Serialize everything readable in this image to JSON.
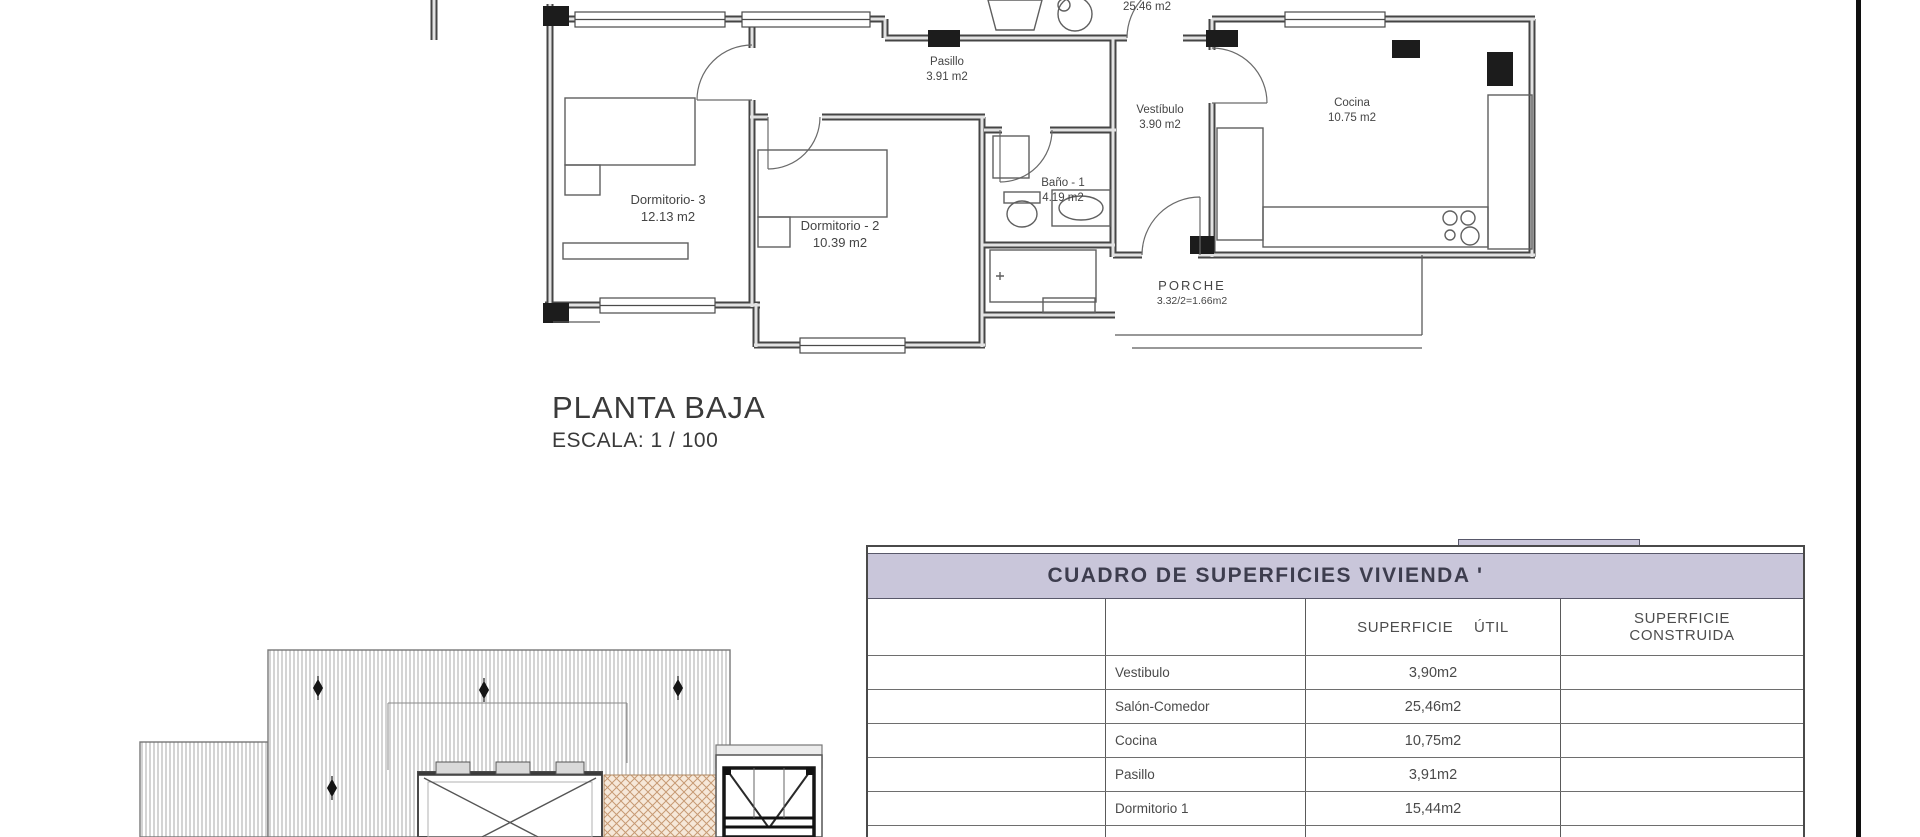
{
  "floor_plan": {
    "title": "PLANTA BAJA",
    "scale": "ESCALA: 1 / 100",
    "rooms": {
      "salon": {
        "area": "25.46 m2"
      },
      "pasillo": {
        "name": "Pasillo",
        "area": "3.91 m2"
      },
      "vestibulo": {
        "name": "Vestíbulo",
        "area": "3.90 m2"
      },
      "cocina": {
        "name": "Cocina",
        "area": "10.75 m2"
      },
      "dormitorio3": {
        "name": "Dormitorio- 3",
        "area": "12.13 m2"
      },
      "dormitorio2": {
        "name": "Dormitorio - 2",
        "area": "10.39 m2"
      },
      "bano1": {
        "name": "Baño - 1",
        "area": "4.19 m2"
      },
      "porche": {
        "name": "PORCHE",
        "area": "3.32/2=1.66m2"
      }
    }
  },
  "table": {
    "title": "CUADRO DE SUPERFICIES  VIVIENDA '",
    "columns": {
      "util": "SUPERFICIE ÚTIL",
      "construida_line1": "SUPERFICIE",
      "construida_line2": "CONSTRUIDA"
    },
    "rows": [
      {
        "name": "Vestibulo",
        "util": "3,90m2",
        "construida": ""
      },
      {
        "name": "Salón-Comedor",
        "util": "25,46m2",
        "construida": ""
      },
      {
        "name": "Cocina",
        "util": "10,75m2",
        "construida": ""
      },
      {
        "name": "Pasillo",
        "util": "3,91m2",
        "construida": ""
      },
      {
        "name": "Dormitorio 1",
        "util": "15,44m2",
        "construida": ""
      },
      {
        "name": "Dormitorio 2",
        "util": "10,39m2",
        "construida": ""
      }
    ]
  },
  "colors": {
    "band": "#c9c6da",
    "wall": "#454545",
    "roof_hatch": "#9f9f9f",
    "porch_lattice_bg": "#f6e8d9",
    "porch_lattice_line": "#c79a74",
    "page_border": "#101010"
  }
}
